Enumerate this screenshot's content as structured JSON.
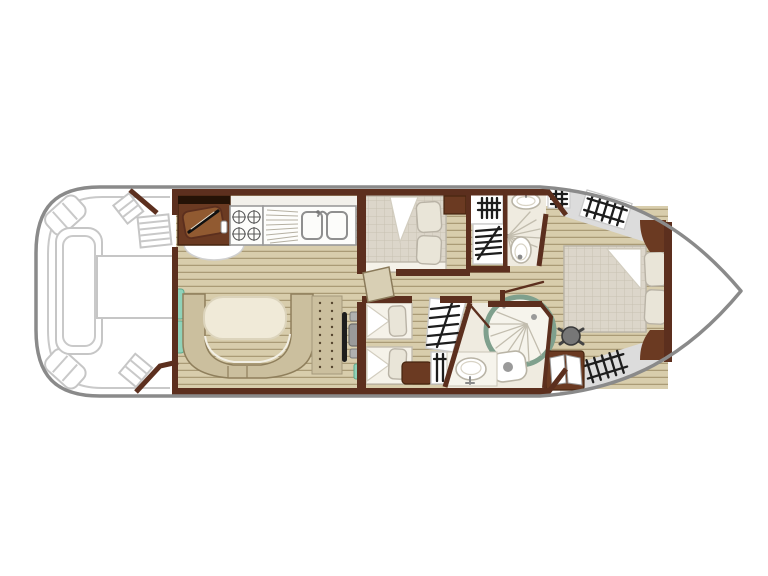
{
  "figure": {
    "type": "boat-floor-plan",
    "description_visible_text": "",
    "sections": [
      "aft-deck",
      "saloon-galley",
      "dinette",
      "helm-station",
      "mid-cabin-double",
      "mid-cabin-twin",
      "bathroom-forward-top",
      "bathroom-forward-bottom",
      "corridor",
      "bow-cabin",
      "bow-deck"
    ],
    "icons": [
      "knife-icon",
      "stove-burner-icon",
      "sink-basin-icon",
      "drainboard-icon",
      "steps-hatch-icon",
      "shower-fan-icon",
      "toilet-icon",
      "washbasin-icon",
      "ladder-icon",
      "stool-icon",
      "wardrobe-doors-icon"
    ]
  },
  "colors": {
    "hull_outline": "#8a8a8a",
    "deck_furniture_outline": "#c6c6c6",
    "wall": "#5c2f1e",
    "cabinet_dark": "#6b3a22",
    "cabinet_top_band": "#241206",
    "cutting_board": "#915a31",
    "wood_base": "#d8cdac",
    "wood_stripe": "#aa9b76",
    "mattress": "#dcd6ca",
    "mattress_grid": "#c8c1b2",
    "pillow": "#e9e5d8",
    "bench": "#cbbf9e",
    "bench_outline": "#8f7f5c",
    "table_cream": "#f0ead8",
    "teal": "#8fd2b9",
    "shower_ring": "#7fa08d",
    "bathroom_floor": "#efebe0",
    "gray_deck": "#dcdcdc",
    "black_detail": "#1d1d1d",
    "seat_gray": "#9a9a9a",
    "white": "#ffffff"
  }
}
